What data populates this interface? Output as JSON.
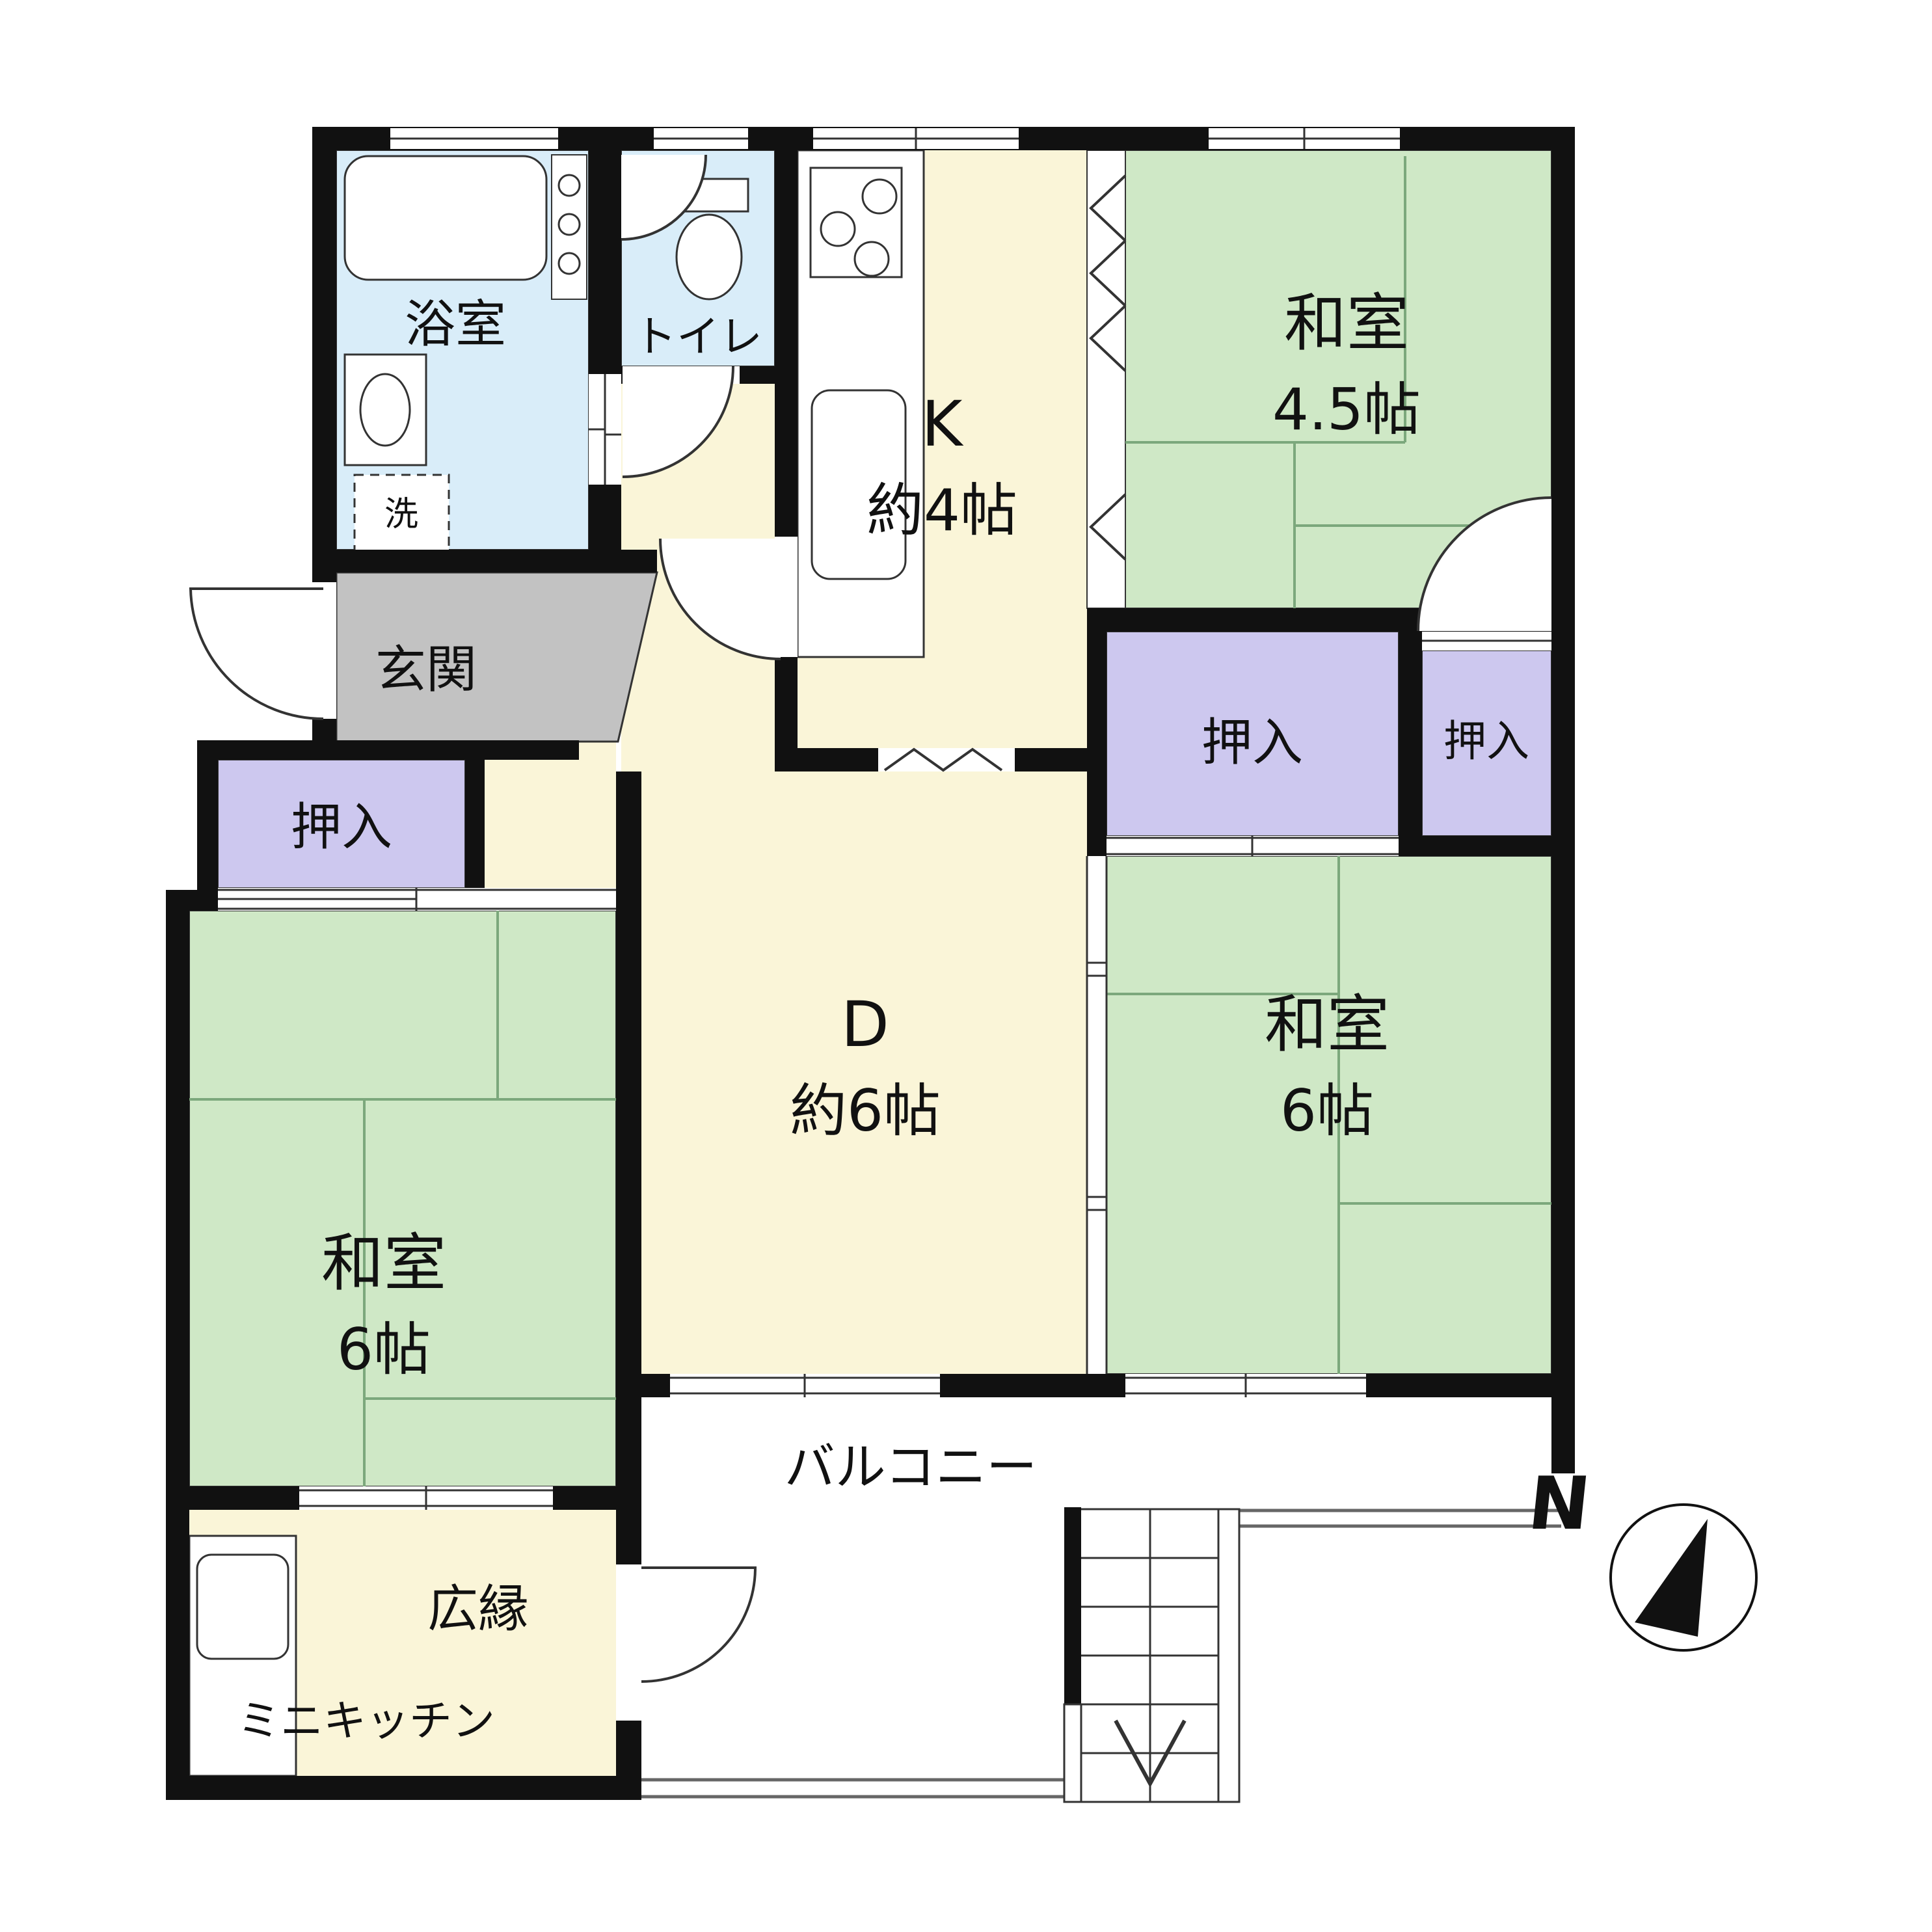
{
  "colors": {
    "tatami": "#cfe8c6",
    "water": "#d9edf9",
    "cream": "#faf5d8",
    "closet": "#cdc8ef",
    "genkan": "#c2c2c2",
    "wall": "#111111",
    "line": "#333333",
    "tatami_line": "#7ca87c"
  },
  "rooms": {
    "bath": {
      "label": "浴室"
    },
    "laundry": {
      "label": "洗"
    },
    "toilet": {
      "label": "トイレ"
    },
    "kitchen": {
      "label": "K",
      "size": "約4帖"
    },
    "washitsu_45": {
      "label": "和室",
      "size": "4.5帖"
    },
    "closet_right": {
      "label": "押入"
    },
    "closet_corner": {
      "label": "押入"
    },
    "closet_left": {
      "label": "押入"
    },
    "dining": {
      "label": "D",
      "size": "約6帖"
    },
    "washitsu_right": {
      "label": "和室",
      "size": "6帖"
    },
    "washitsu_left": {
      "label": "和室",
      "size": "6帖"
    },
    "genkan": {
      "label": "玄関"
    },
    "hiroen": {
      "label": "広縁"
    },
    "mini_kitchen": {
      "label": "ミニキッチン"
    },
    "balcony": {
      "label": "バルコニー"
    }
  },
  "compass": {
    "label": "N"
  }
}
